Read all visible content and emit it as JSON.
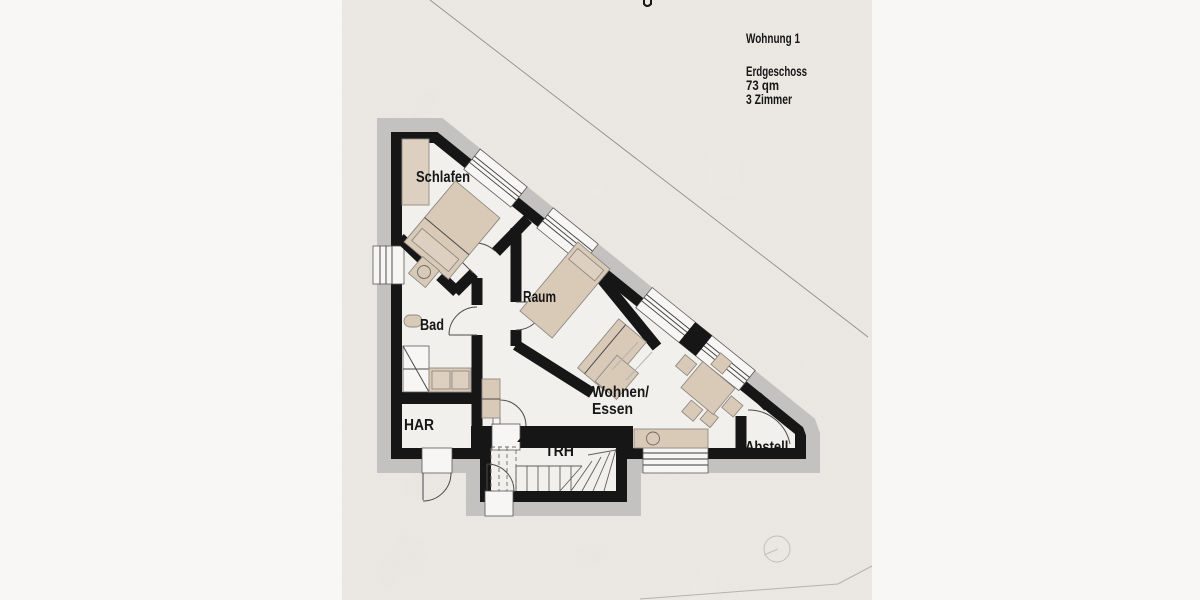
{
  "header": {
    "apartment": "Wohnung 1",
    "floor": "Erdgeschoss",
    "area": "73 qm",
    "rooms_count": "3 Zimmer"
  },
  "room_labels": {
    "bedroom": "Schlafen",
    "room": "Raum",
    "bath": "Bad",
    "utility": "HAR",
    "living_line1": "Wohnen/",
    "living_line2": "Essen",
    "stairwell": "TRH",
    "storage": "Abstell."
  },
  "colors": {
    "wall": "#161616",
    "insulation": "#c3c2c0",
    "floor": "#f2f0ec",
    "paper": "#edeae5",
    "margin": "#f8f7f5",
    "furniture": "#d9cab8"
  }
}
